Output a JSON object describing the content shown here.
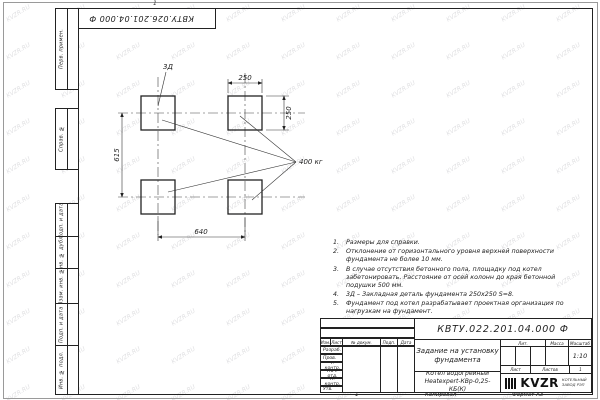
{
  "sheet": {
    "watermark": "KVZR.RU",
    "top_zone_label": "1",
    "bottom_zone_label": "1"
  },
  "top_stamp": "КВТУ.026.201.04.000 Ф",
  "side_columns": [
    "Перв. примен.",
    "Справ. №",
    "Подп. и дата",
    "Инв. № дубл.",
    "Взам. инв. №",
    "Подп. и дата",
    "Инв. № подл."
  ],
  "drawing": {
    "labels": {
      "embed": "3Д",
      "weight": "400 кг"
    },
    "dimensions": {
      "top_width": "250",
      "right_height": "250",
      "left_height": "615",
      "bottom_width": "640"
    }
  },
  "notes": [
    {
      "num": "1.",
      "text": "Размеры для справки."
    },
    {
      "num": "2.",
      "text": "Отклонение от горизонтального уровня верхней поверхности фундамента не более 10 мм."
    },
    {
      "num": "3.",
      "text": "В случае отсутствия бетонного пола, площадку под котел забетонировать. Расстояние от осей колонн до края бетонной подушки 500 мм."
    },
    {
      "num": "4.",
      "text": "3Д – Закладная деталь фундамента 250х250 S=8."
    },
    {
      "num": "5.",
      "text": "Фундамент под котел разрабатывает проектная организация по нагрузкам на фундамент."
    }
  ],
  "title_block": {
    "doc_number": "КВТУ.022.201.04.000 Ф",
    "title_line1": "Задание на установку",
    "title_line2": "фундамента",
    "header_cols": [
      "Изм.",
      "Лист",
      "№ докум.",
      "Подп.",
      "Дата"
    ],
    "sign_rows": [
      "Разраб.",
      "Пров.",
      "Т. контр.",
      "Нач. отд.",
      "Н. контр.",
      "Утв."
    ],
    "lit_label": "Лит.",
    "mass_label": "Масса",
    "scale_label": "Масштаб",
    "scale_value": "1:10",
    "sheet_label": "Лист",
    "sheets_label": "Листов",
    "sheets_value": "1",
    "product_line1": "Котел водогрейный",
    "product_line2": "Heatexpert-КВр-0,25- КБ(К)",
    "logo_text": "KVZR",
    "logo_caption_line1": "КОТЕЛЬНЫЙ",
    "logo_caption_line2": "ЗАВОД РЭП",
    "copied_label": "Копировал",
    "format_label": "Формат А3"
  }
}
